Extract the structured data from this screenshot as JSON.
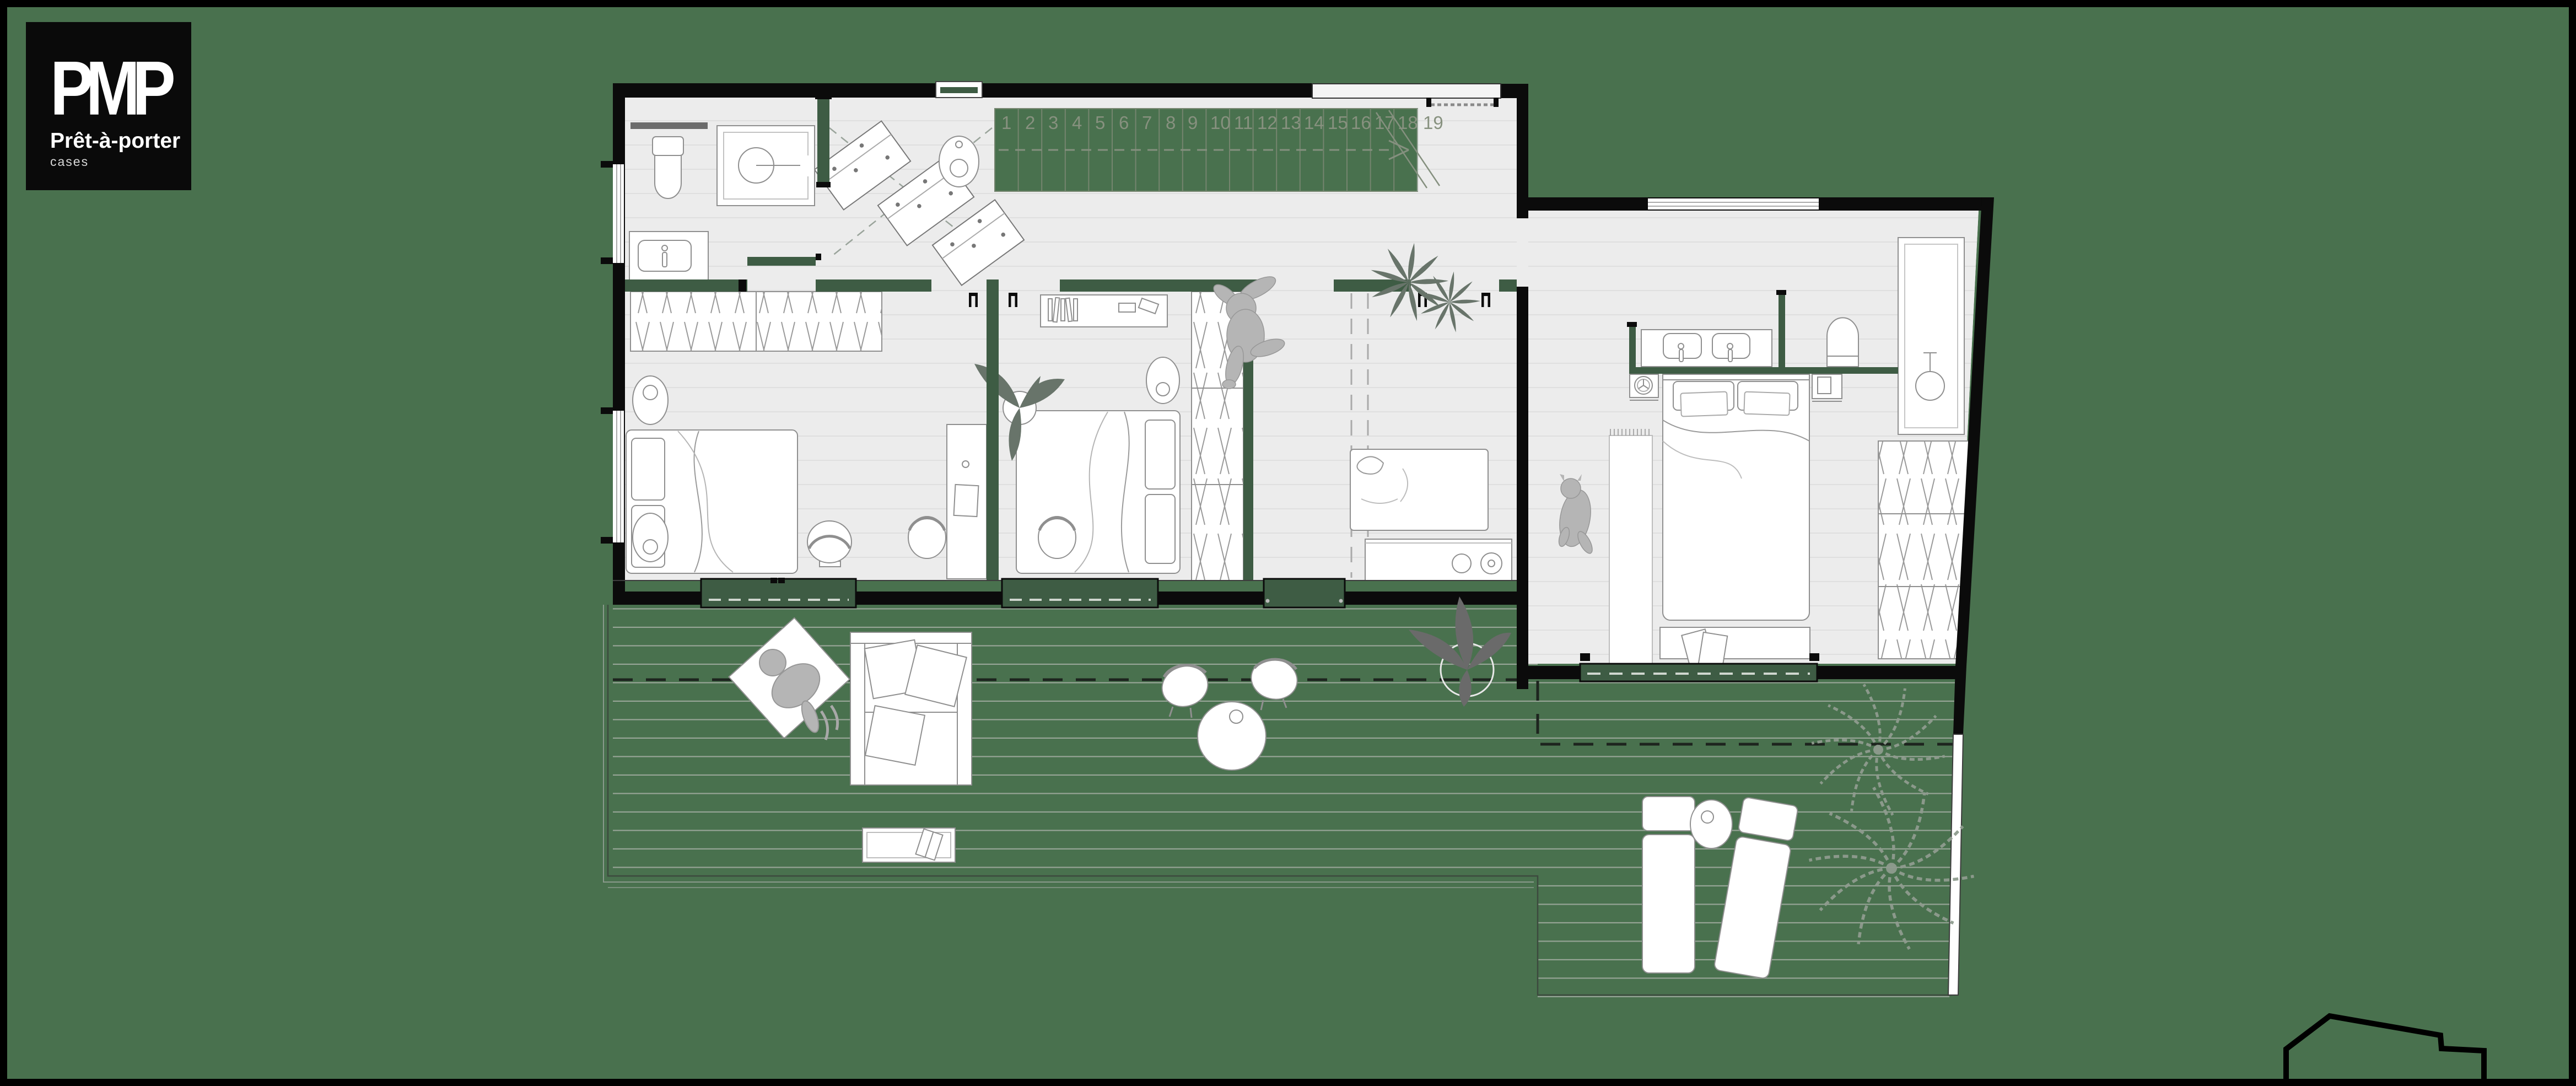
{
  "logo": {
    "brand": "PMP",
    "name": "Prêt-à-porter",
    "sub": "cases"
  },
  "stairs": {
    "count": 19,
    "numbers": [
      "1",
      "2",
      "3",
      "4",
      "5",
      "6",
      "7",
      "8",
      "9",
      "10",
      "11",
      "12",
      "13",
      "14",
      "15",
      "16",
      "17",
      "18",
      "19"
    ]
  },
  "colors": {
    "background": "#49714E",
    "exterior_wall": "#0B0B0B",
    "interior_wall": "#3E5C44",
    "floor": "#ECECEC",
    "floor_line": "#DFDFDF",
    "deck_line": "#96A496",
    "furniture_outline": "#8F8F8F",
    "silhouette_gray": "#B5B5B5",
    "plant_dark": "#68746A",
    "palm_outline": "#8F9C8F",
    "stair_marking": "#85907F",
    "white": "#FFFFFF"
  },
  "glyphs": [
    "toilet",
    "shower",
    "sink",
    "double-sink-vanity",
    "washing-machine",
    "drying-rack",
    "staircase",
    "bed",
    "pillow",
    "wardrobe-hanging",
    "desk",
    "chair",
    "pouf",
    "rug",
    "bench",
    "daybed",
    "kitchen-counter",
    "round-table",
    "outdoor-sofa",
    "hanging-chair",
    "sun-lounger",
    "side-table",
    "potted-plant",
    "palm-tree",
    "person-silhouette",
    "dog-silhouette",
    "sliding-door"
  ]
}
